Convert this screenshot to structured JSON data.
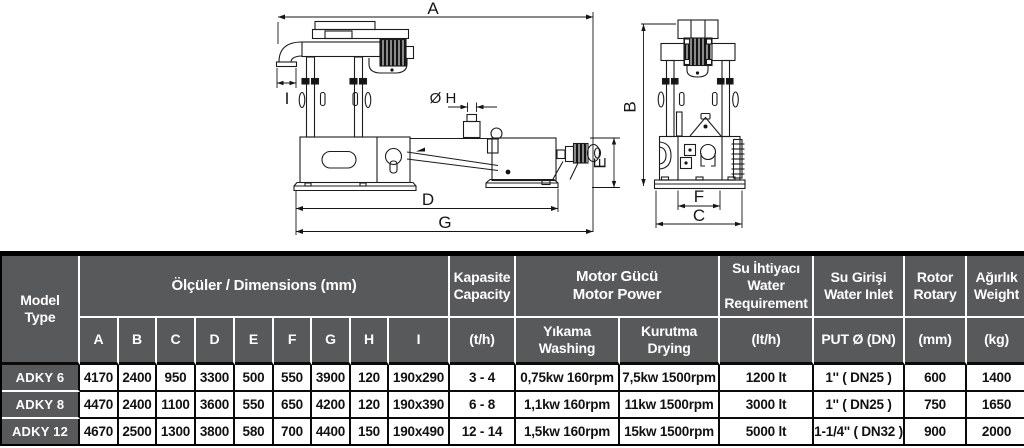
{
  "colors": {
    "header_bg": "#58595b",
    "header_text": "#ffffff",
    "grid": "#0a0a0a",
    "line": "#1c1c1c"
  },
  "diagram": {
    "labels": {
      "dim_a": "A",
      "dim_b": "B",
      "dim_c": "C",
      "dim_d": "D",
      "dim_e": "E",
      "dim_f": "F",
      "dim_g": "G",
      "dim_h": "Ø H",
      "dim_i": "I"
    }
  },
  "table": {
    "header": {
      "model": "Model\nType",
      "dimensions_title": "Ölçüler / Dimensions (mm)",
      "dimension_columns": [
        "A",
        "B",
        "C",
        "D",
        "E",
        "F",
        "G",
        "H",
        "I"
      ],
      "capacity_title": "Kapasite\nCapacity",
      "capacity_unit": "(t/h)",
      "motor_title": "Motor Gücü\nMotor Power",
      "washing": "Yıkama\nWashing",
      "drying": "Kurutma\nDrying",
      "water_req_title": "Su İhtiyacı\nWater\nRequirement",
      "water_req_unit": "(lt/h)",
      "water_inlet_title": "Su Girişi\nWater Inlet",
      "water_inlet_unit": "PUT Ø (DN)",
      "rotor_title": "Rotor\nRotary",
      "rotor_unit": "(mm)",
      "weight_title": "Ağırlık\nWeight",
      "weight_unit": "(kg)"
    },
    "rows": [
      {
        "model": "ADKY 6",
        "dims": [
          "4170",
          "2400",
          "950",
          "3300",
          "500",
          "550",
          "3900",
          "120",
          "190x290"
        ],
        "capacity": "3 - 4",
        "washing": "0,75kw 160rpm",
        "drying": "7,5kw 1500rpm",
        "water": "1200 lt",
        "inlet": "1'' ( DN25 )",
        "rotor": "600",
        "weight": "1400"
      },
      {
        "model": "ADKY 8",
        "dims": [
          "4470",
          "2400",
          "1100",
          "3600",
          "550",
          "650",
          "4200",
          "120",
          "190x390"
        ],
        "capacity": "6 - 8",
        "washing": "1,1kw 160rpm",
        "drying": "11kw 1500rpm",
        "water": "3000 lt",
        "inlet": "1'' ( DN25 )",
        "rotor": "750",
        "weight": "1650"
      },
      {
        "model": "ADKY 12",
        "dims": [
          "4670",
          "2500",
          "1300",
          "3800",
          "580",
          "700",
          "4400",
          "150",
          "190x490"
        ],
        "capacity": "12 - 14",
        "washing": "1,5kw 160rpm",
        "drying": "15kw 1500rpm",
        "water": "5000 lt",
        "inlet": "1-1/4'' ( DN32 )",
        "rotor": "900",
        "weight": "2000"
      }
    ]
  }
}
